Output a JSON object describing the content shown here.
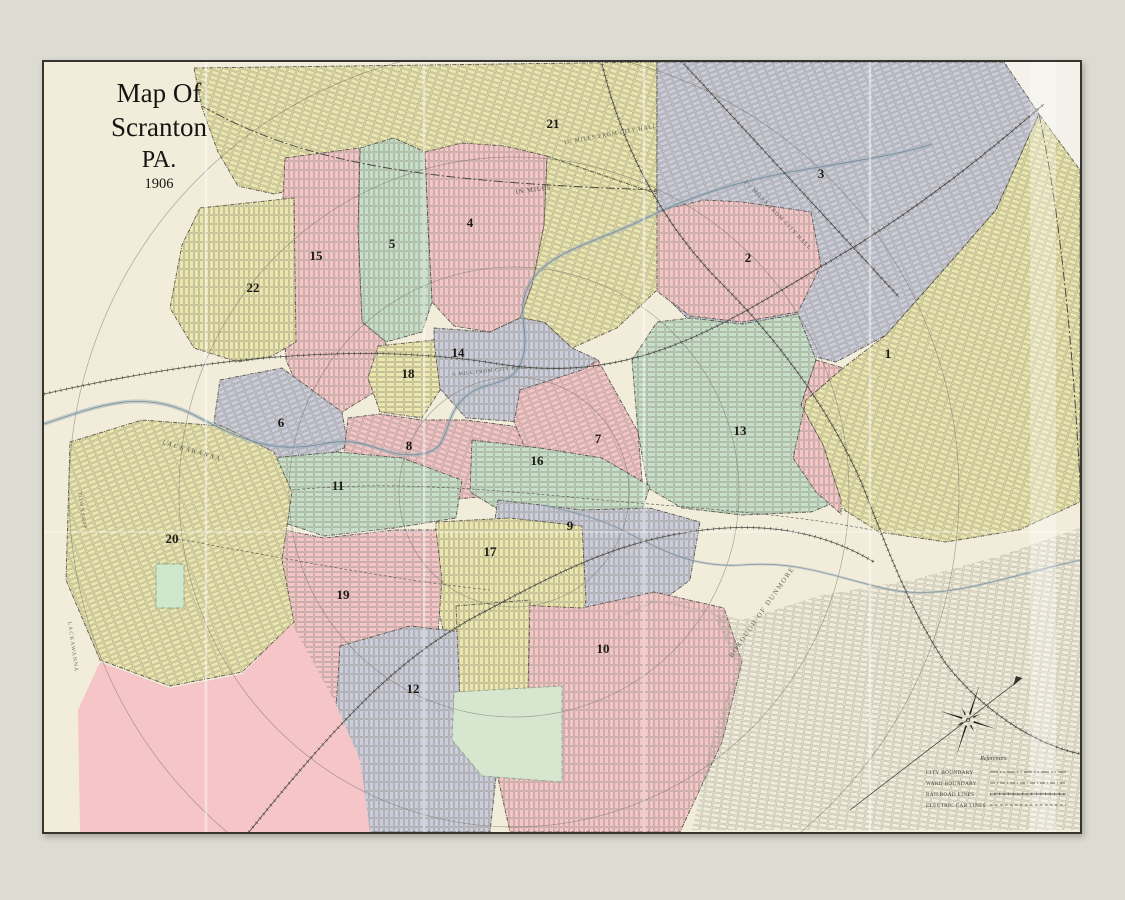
{
  "title_block": {
    "line1": "Map Of",
    "line2": "Scranton",
    "line3": "PA.",
    "line4": "1906"
  },
  "map": {
    "outer_background": "#dcdcd3",
    "paper": "#f2edda",
    "border_color": "#35342e",
    "palette": {
      "pink": "#f5c5c8",
      "yellow": "#ece7ae",
      "green": "#c6e0c9",
      "lavender": "#cbccdc",
      "white": "#f3f1e9"
    },
    "street_color": "#8a8878",
    "street_color_gray": "#9a9990",
    "patterns": [
      {
        "id": "gridV",
        "rot": 90,
        "color": "#8a8878"
      },
      {
        "id": "gridH",
        "rot": 0,
        "color": "#8a8878"
      },
      {
        "id": "gridD1",
        "rot": 18,
        "color": "#8a8878"
      },
      {
        "id": "gridD2",
        "rot": -22,
        "color": "#8a8878"
      },
      {
        "id": "gridGray",
        "rot": 8,
        "color": "#9a9990"
      }
    ],
    "regions": [
      {
        "name": "region-topright-white",
        "fill": "#f3f1e9",
        "stroke": false,
        "points": "958,0 1036,0 1036,112 993,52"
      },
      {
        "name": "ward-21",
        "fill": "yellow",
        "pattern": "gridD1",
        "label": {
          "text": "21",
          "x": 509,
          "y": 66
        },
        "points": "150,6 613,0 613,130 543,120 478,132 418,122 353,129 288,120 230,132 194,124 174,90 158,46"
      },
      {
        "name": "ward-3",
        "fill": "lavender",
        "pattern": "gridD2",
        "label": {
          "text": "3",
          "x": 777,
          "y": 116
        },
        "points": "613,0 960,0 995,52 952,148 889,220 842,273 792,300 732,285 657,270 613,226"
      },
      {
        "name": "ward-1",
        "fill": "yellow",
        "pattern": "gridD1",
        "label": {
          "text": "1",
          "x": 844,
          "y": 296
        },
        "points": "842,273 889,220 952,148 995,52 1036,108 1036,440 975,468 902,480 835,470 772,430 749,396 762,338 799,306"
      },
      {
        "name": "ward-2",
        "fill": "pink",
        "pattern": "gridV",
        "label": {
          "text": "2",
          "x": 704,
          "y": 200
        },
        "points": "609,150 660,138 698,140 767,150 777,203 754,250 698,260 646,254 614,230 602,190"
      },
      {
        "name": "ward-13",
        "fill": "green",
        "pattern": "gridH",
        "label": {
          "text": "13",
          "x": 696,
          "y": 373
        },
        "points": "588,298 613,260 646,256 698,262 754,252 772,298 757,343 779,383 797,438 767,450 698,453 638,446 604,426 594,370"
      },
      {
        "name": "region-pink-strip-east",
        "fill": "pink",
        "pattern": "gridV",
        "points": "772,298 799,306 762,338 749,396 772,430 797,452 797,438 779,383 757,343"
      },
      {
        "name": "region-yellow-central",
        "fill": "yellow",
        "pattern": "gridD1",
        "points": "503,94 613,132 613,228 573,266 528,286 500,260 476,256 488,223 500,163"
      },
      {
        "name": "ward-4",
        "fill": "pink",
        "pattern": "gridV",
        "label": {
          "text": "4",
          "x": 426,
          "y": 165
        },
        "points": "381,90 418,81 460,84 503,94 500,163 488,223 476,256 446,270 410,264 388,240 384,163"
      },
      {
        "name": "ward-5",
        "fill": "green",
        "pattern": "gridV",
        "label": {
          "text": "5",
          "x": 348,
          "y": 186
        },
        "points": "316,86 350,76 381,90 384,163 388,240 378,270 342,280 318,260 314,168"
      },
      {
        "name": "ward-15",
        "fill": "pink",
        "pattern": "gridV",
        "label": {
          "text": "15",
          "x": 272,
          "y": 198
        },
        "points": "241,96 316,86 314,168 318,260 342,280 334,328 298,350 260,338 242,298 236,193"
      },
      {
        "name": "ward-22",
        "fill": "yellow",
        "pattern": "gridV",
        "label": {
          "text": "22",
          "x": 209,
          "y": 230
        },
        "points": "156,146 250,136 252,280 228,294 194,300 150,286 126,246 138,183"
      },
      {
        "name": "ward-6",
        "fill": "lavender",
        "pattern": "gridD2",
        "label": {
          "text": "6",
          "x": 237,
          "y": 365
        },
        "points": "176,318 238,306 298,350 304,384 260,406 203,400 170,360"
      },
      {
        "name": "ward-14",
        "fill": "lavender",
        "pattern": "gridV",
        "label": {
          "text": "14",
          "x": 414,
          "y": 295
        },
        "points": "390,266 446,270 476,256 500,260 528,286 554,298 538,340 478,360 422,356 390,320"
      },
      {
        "name": "ward-18",
        "fill": "yellow",
        "pattern": "gridH",
        "label": {
          "text": "18",
          "x": 364,
          "y": 316
        },
        "points": "334,284 390,278 396,328 378,356 336,350 324,316"
      },
      {
        "name": "ward-8",
        "fill": "pink",
        "pattern": "gridD1",
        "label": {
          "text": "8",
          "x": 365,
          "y": 388
        },
        "points": "304,356 336,352 378,358 422,358 468,364 503,376 496,418 446,434 380,440 328,420 300,390"
      },
      {
        "name": "ward-7",
        "fill": "pink",
        "pattern": "gridD2",
        "label": {
          "text": "7",
          "x": 554,
          "y": 381
        },
        "points": "476,328 538,308 554,298 594,370 598,418 558,430 510,424 486,398 470,360"
      },
      {
        "name": "ward-16",
        "fill": "green",
        "pattern": "gridH",
        "label": {
          "text": "16",
          "x": 493,
          "y": 403
        },
        "points": "428,378 496,386 558,396 606,424 598,448 538,460 468,456 426,430"
      },
      {
        "name": "ward-11",
        "fill": "green",
        "pattern": "gridH",
        "label": {
          "text": "11",
          "x": 294,
          "y": 428
        },
        "points": "226,396 294,390 358,396 418,418 412,456 350,466 280,474 226,456"
      },
      {
        "name": "ward-9",
        "fill": "lavender",
        "pattern": "gridV",
        "label": {
          "text": "9",
          "x": 526,
          "y": 468
        },
        "points": "454,438 538,448 606,446 656,460 646,518 598,554 526,560 466,540 446,488"
      },
      {
        "name": "ward-17",
        "fill": "yellow",
        "pattern": "gridV",
        "label": {
          "text": "17",
          "x": 446,
          "y": 494
        },
        "points": "392,460 466,456 538,464 542,538 526,618 496,660 446,650 406,598 390,528"
      },
      {
        "name": "ward-19",
        "fill": "pink",
        "pattern": "gridH",
        "label": {
          "text": "19",
          "x": 299,
          "y": 537
        },
        "points": "216,463 280,476 350,468 392,468 398,518 392,598 356,650 286,660 226,630 206,558"
      },
      {
        "name": "ward-20",
        "fill": "yellow",
        "pattern": "gridD2",
        "label": {
          "text": "20",
          "x": 128,
          "y": 481
        },
        "points": "26,380 98,358 178,364 230,390 248,430 238,498 250,560 198,610 126,624 56,598 22,518"
      },
      {
        "name": "park-central",
        "fill": "#cfe7cb",
        "stroke_color": "#7a9a7a",
        "points": "112,502 140,502 140,546 112,546"
      },
      {
        "name": "ward-12",
        "fill": "lavender",
        "pattern": "gridV",
        "label": {
          "text": "12",
          "x": 369,
          "y": 631
        },
        "points": "296,584 366,564 418,570 448,610 456,678 446,770 316,770 290,678"
      },
      {
        "name": "ward-10",
        "fill": "pink",
        "pattern": "gridV",
        "label": {
          "text": "10",
          "x": 559,
          "y": 591
        },
        "points": "450,542 538,546 610,530 680,546 698,600 678,680 636,770 466,770 450,698 444,618"
      },
      {
        "name": "region-yellow-strip",
        "fill": "yellow",
        "pattern": "gridV",
        "points": "412,544 486,538 484,628 450,660 416,638"
      },
      {
        "name": "park-nay-aug",
        "fill": "#d6e6cf",
        "stroke_color": "#7a9a7a",
        "points": "410,630 518,624 518,720 438,714 408,678"
      },
      {
        "name": "region-bottomleft-pink",
        "fill": "pink",
        "stroke": false,
        "points": "36,770 34,648 56,600 126,626 198,612 248,562 290,638 316,698 326,770"
      },
      {
        "name": "region-dunmore-streets",
        "fill": "none",
        "pattern": "gridGray",
        "stroke": false,
        "points": "558,563 618,538 698,558 778,533 868,518 958,493 1036,466 1036,768 648,768 668,678 693,603 670,553 608,538"
      }
    ],
    "river": {
      "name": "lackawanna-river",
      "main": "M0,362 C58,342 98,328 148,352 C198,378 228,392 278,382 C328,372 338,398 378,392 C408,387 398,358 418,338 C438,316 468,328 478,298 C488,268 468,248 488,218 C508,188 558,178 598,158 C648,133 698,118 758,108 C818,98 858,92 888,82",
      "brook": "M1036,498 C950,518 900,538 848,528 C798,518 758,498 698,503 C648,506 618,488 578,468 C548,453 518,448 498,443"
    },
    "railroads": [
      "M0,332 C150,298 310,278 455,302 C600,325 690,255 810,185 C890,135 950,85 1000,42",
      "M205,770 C300,652 355,598 425,558 C505,515 565,482 645,470 C720,458 780,470 830,500",
      "M558,2 C578,85 618,162 678,222 C738,282 788,352 818,422 C838,472 862,542 902,602 C942,652 992,682 1036,692",
      "M640,2 L855,235"
    ],
    "electric_lines": [
      "M248,428 C350,418 450,428 558,438 C650,446 748,452 828,468",
      "M128,476 C250,498 350,518 446,528"
    ],
    "boundary_paths": [
      "M158,44 C260,102 380,120 613,128",
      "M995,52 C1018,160 1030,300 1037,440"
    ],
    "circles": {
      "cx": 470,
      "cy": 430,
      "radii": [
        115,
        225,
        335,
        445
      ]
    },
    "annotations": [
      {
        "text": "LACKAWANNA",
        "x": 118,
        "y": 382,
        "rotate": 16,
        "size": 6.5,
        "spacing": 2,
        "color": "#5a5a52",
        "italic": true
      },
      {
        "text": "BOROUGH OF DUNMORE",
        "x": 688,
        "y": 596,
        "rotate": -55,
        "size": 7,
        "spacing": 1.5,
        "color": "#6a6a62",
        "italic": false
      },
      {
        "text": "IN MILES",
        "x": 472,
        "y": 132,
        "rotate": -8,
        "size": 6.5,
        "spacing": 1,
        "color": "#4a4a42",
        "italic": false
      },
      {
        "text": "1½ MILES FROM CITY HALL",
        "x": 520,
        "y": 82,
        "rotate": -10,
        "size": 5.5,
        "spacing": 1,
        "color": "#55554d",
        "italic": false
      },
      {
        "text": "2½ MILES FROM CITY HALL",
        "x": 700,
        "y": 120,
        "rotate": 46,
        "size": 5.5,
        "spacing": 1,
        "color": "#55554d",
        "italic": false
      },
      {
        "text": "½ MILE FROM CITY HALL",
        "x": 408,
        "y": 314,
        "rotate": -6,
        "size": 5,
        "spacing": 0.8,
        "color": "#55554d",
        "italic": false
      },
      {
        "text": "TOWNSHIP",
        "x": 34,
        "y": 430,
        "rotate": 82,
        "size": 5.5,
        "spacing": 1.2,
        "color": "#6a6a62",
        "italic": false
      },
      {
        "text": "LACKAWANNA",
        "x": 24,
        "y": 560,
        "rotate": 82,
        "size": 5.5,
        "spacing": 1.2,
        "color": "#6a6a62",
        "italic": false
      }
    ],
    "compass": {
      "cx": 924,
      "cy": 658
    },
    "legend": {
      "title": "References.",
      "items": [
        {
          "label": "CITY BOUNDARY",
          "style": "city"
        },
        {
          "label": "WARD BOUNDARY",
          "style": "ward"
        },
        {
          "label": "RAILROAD LINES",
          "style": "railroad"
        },
        {
          "label": "ELECTRIC CAR LINES",
          "style": "electric"
        }
      ]
    },
    "creases": {
      "vertical_x": [
        162,
        380,
        600,
        826
      ],
      "horizontal_y": [
        470
      ],
      "band": {
        "x": 986,
        "w": 26
      }
    }
  }
}
